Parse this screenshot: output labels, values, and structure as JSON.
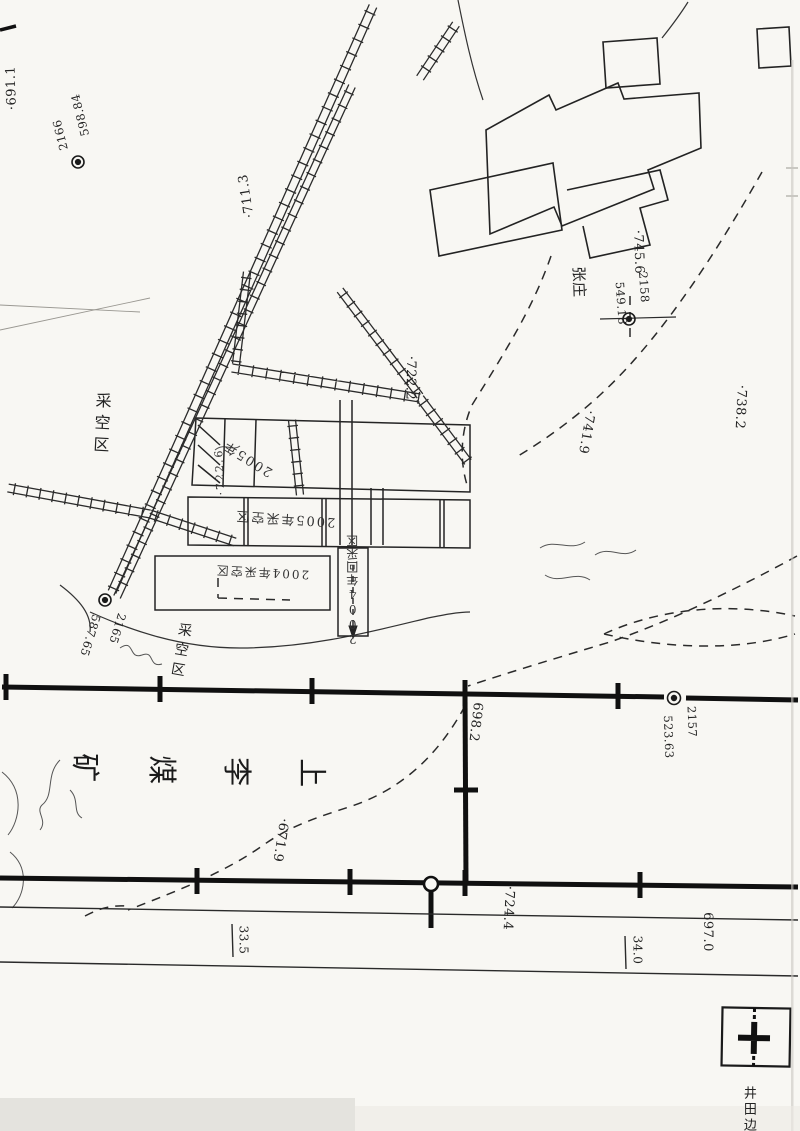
{
  "labels": {
    "elev_top_left": "·691.1",
    "elev_711": "·711.3",
    "elev_722": "·722.2",
    "elev_745": "·745.6",
    "elev_741": "·741.9",
    "elev_738": "·738.2",
    "elev_698": "698.2",
    "elev_671": "·671.9",
    "elev_724": "·724.4",
    "elev_697": "697.0",
    "elev_722_6": "·722.6",
    "dist_33_5": "33.5",
    "dist_34_0": "34.0"
  },
  "survey_points": {
    "p2166": {
      "id": "2166",
      "elevation": "598.84"
    },
    "p2158": {
      "id": "2158",
      "elevation": "549.18"
    },
    "p2165": {
      "id": "2165",
      "elevation": "587.65"
    },
    "p2157": {
      "id": "2157",
      "elevation": "523.63"
    }
  },
  "place_names": {
    "village": "张庄",
    "mine_char_1": "上",
    "mine_char_2": "李",
    "mine_char_3": "煤",
    "mine_char_4": "矿"
  },
  "area_labels": {
    "goaf_1": "采空区",
    "goaf_2": "采空区",
    "goaf_2005": "2005年采空区",
    "goaf_2004": "2004年采空区",
    "working_2004": "2004年回采区",
    "year_2005": "2005年"
  },
  "legend": {
    "boundary_label": "井田边"
  },
  "colors": {
    "ink": "#1d1d1d",
    "boundary": "#101010",
    "paper": "#f8f7f3"
  }
}
